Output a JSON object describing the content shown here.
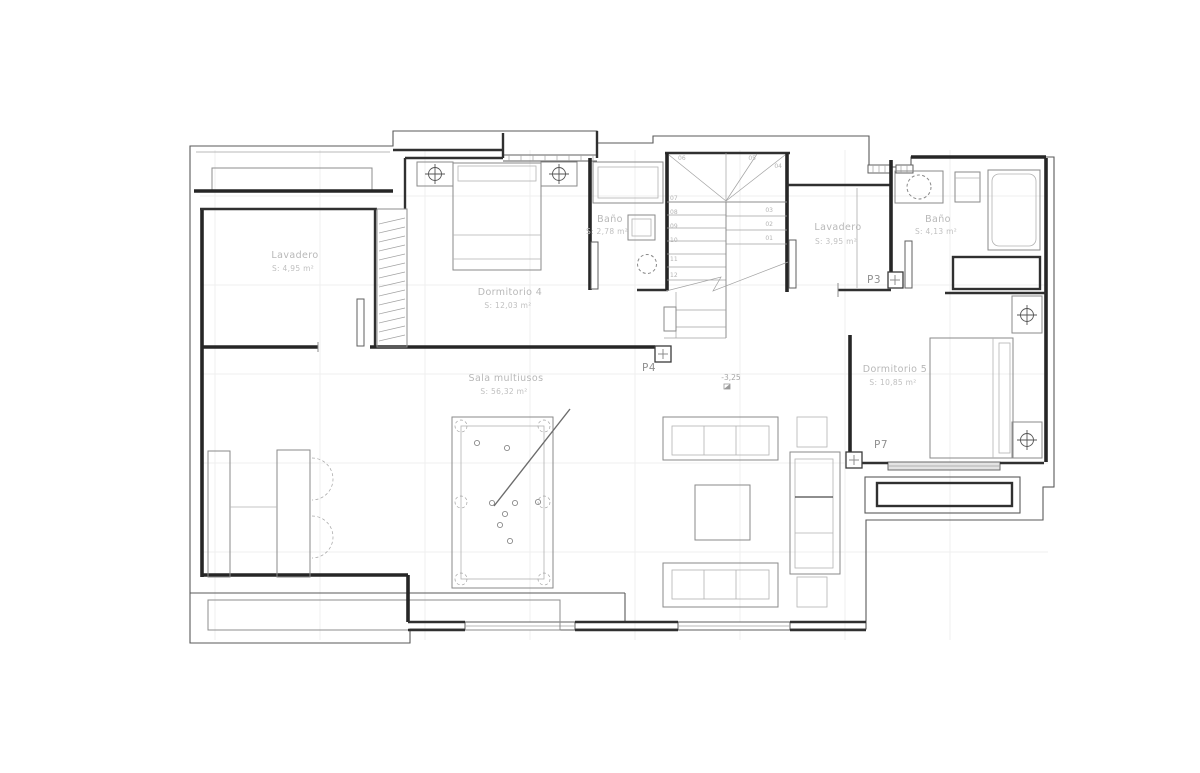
{
  "page": {
    "background": "#ffffff",
    "drawing_type": "architectural floor plan"
  },
  "colors": {
    "walls": "#262626",
    "boundary": "#5a5a5a",
    "furniture": "#8a8a8a",
    "room_labels": "#b8b8b8",
    "door_labels": "#8f8f8f",
    "grid": "#efefef",
    "window_fill": "#e3e3e3"
  },
  "rooms": [
    {
      "name": "Lavadero",
      "area": "S: 4,95 m²"
    },
    {
      "name": "Dormitorio 4",
      "area": "S: 12,03 m²"
    },
    {
      "name": "Baño",
      "area": "S: 2,78 m²"
    },
    {
      "name": "Lavadero",
      "area": "S: 3,95 m²"
    },
    {
      "name": "Baño",
      "area": "S: 4,13 m²"
    },
    {
      "name": "Dormitorio 5",
      "area": "S: 10,85 m²"
    },
    {
      "name": "Sala multiusos",
      "area": "S: 56,32 m²"
    }
  ],
  "doors": [
    {
      "label": "P3"
    },
    {
      "label": "P4"
    },
    {
      "label": "P7"
    }
  ],
  "level_marker": {
    "value": "-3,25"
  },
  "stairs": {
    "steps": [
      "01",
      "02",
      "03",
      "04",
      "05",
      "06",
      "07",
      "08",
      "09",
      "10",
      "11",
      "12"
    ]
  }
}
